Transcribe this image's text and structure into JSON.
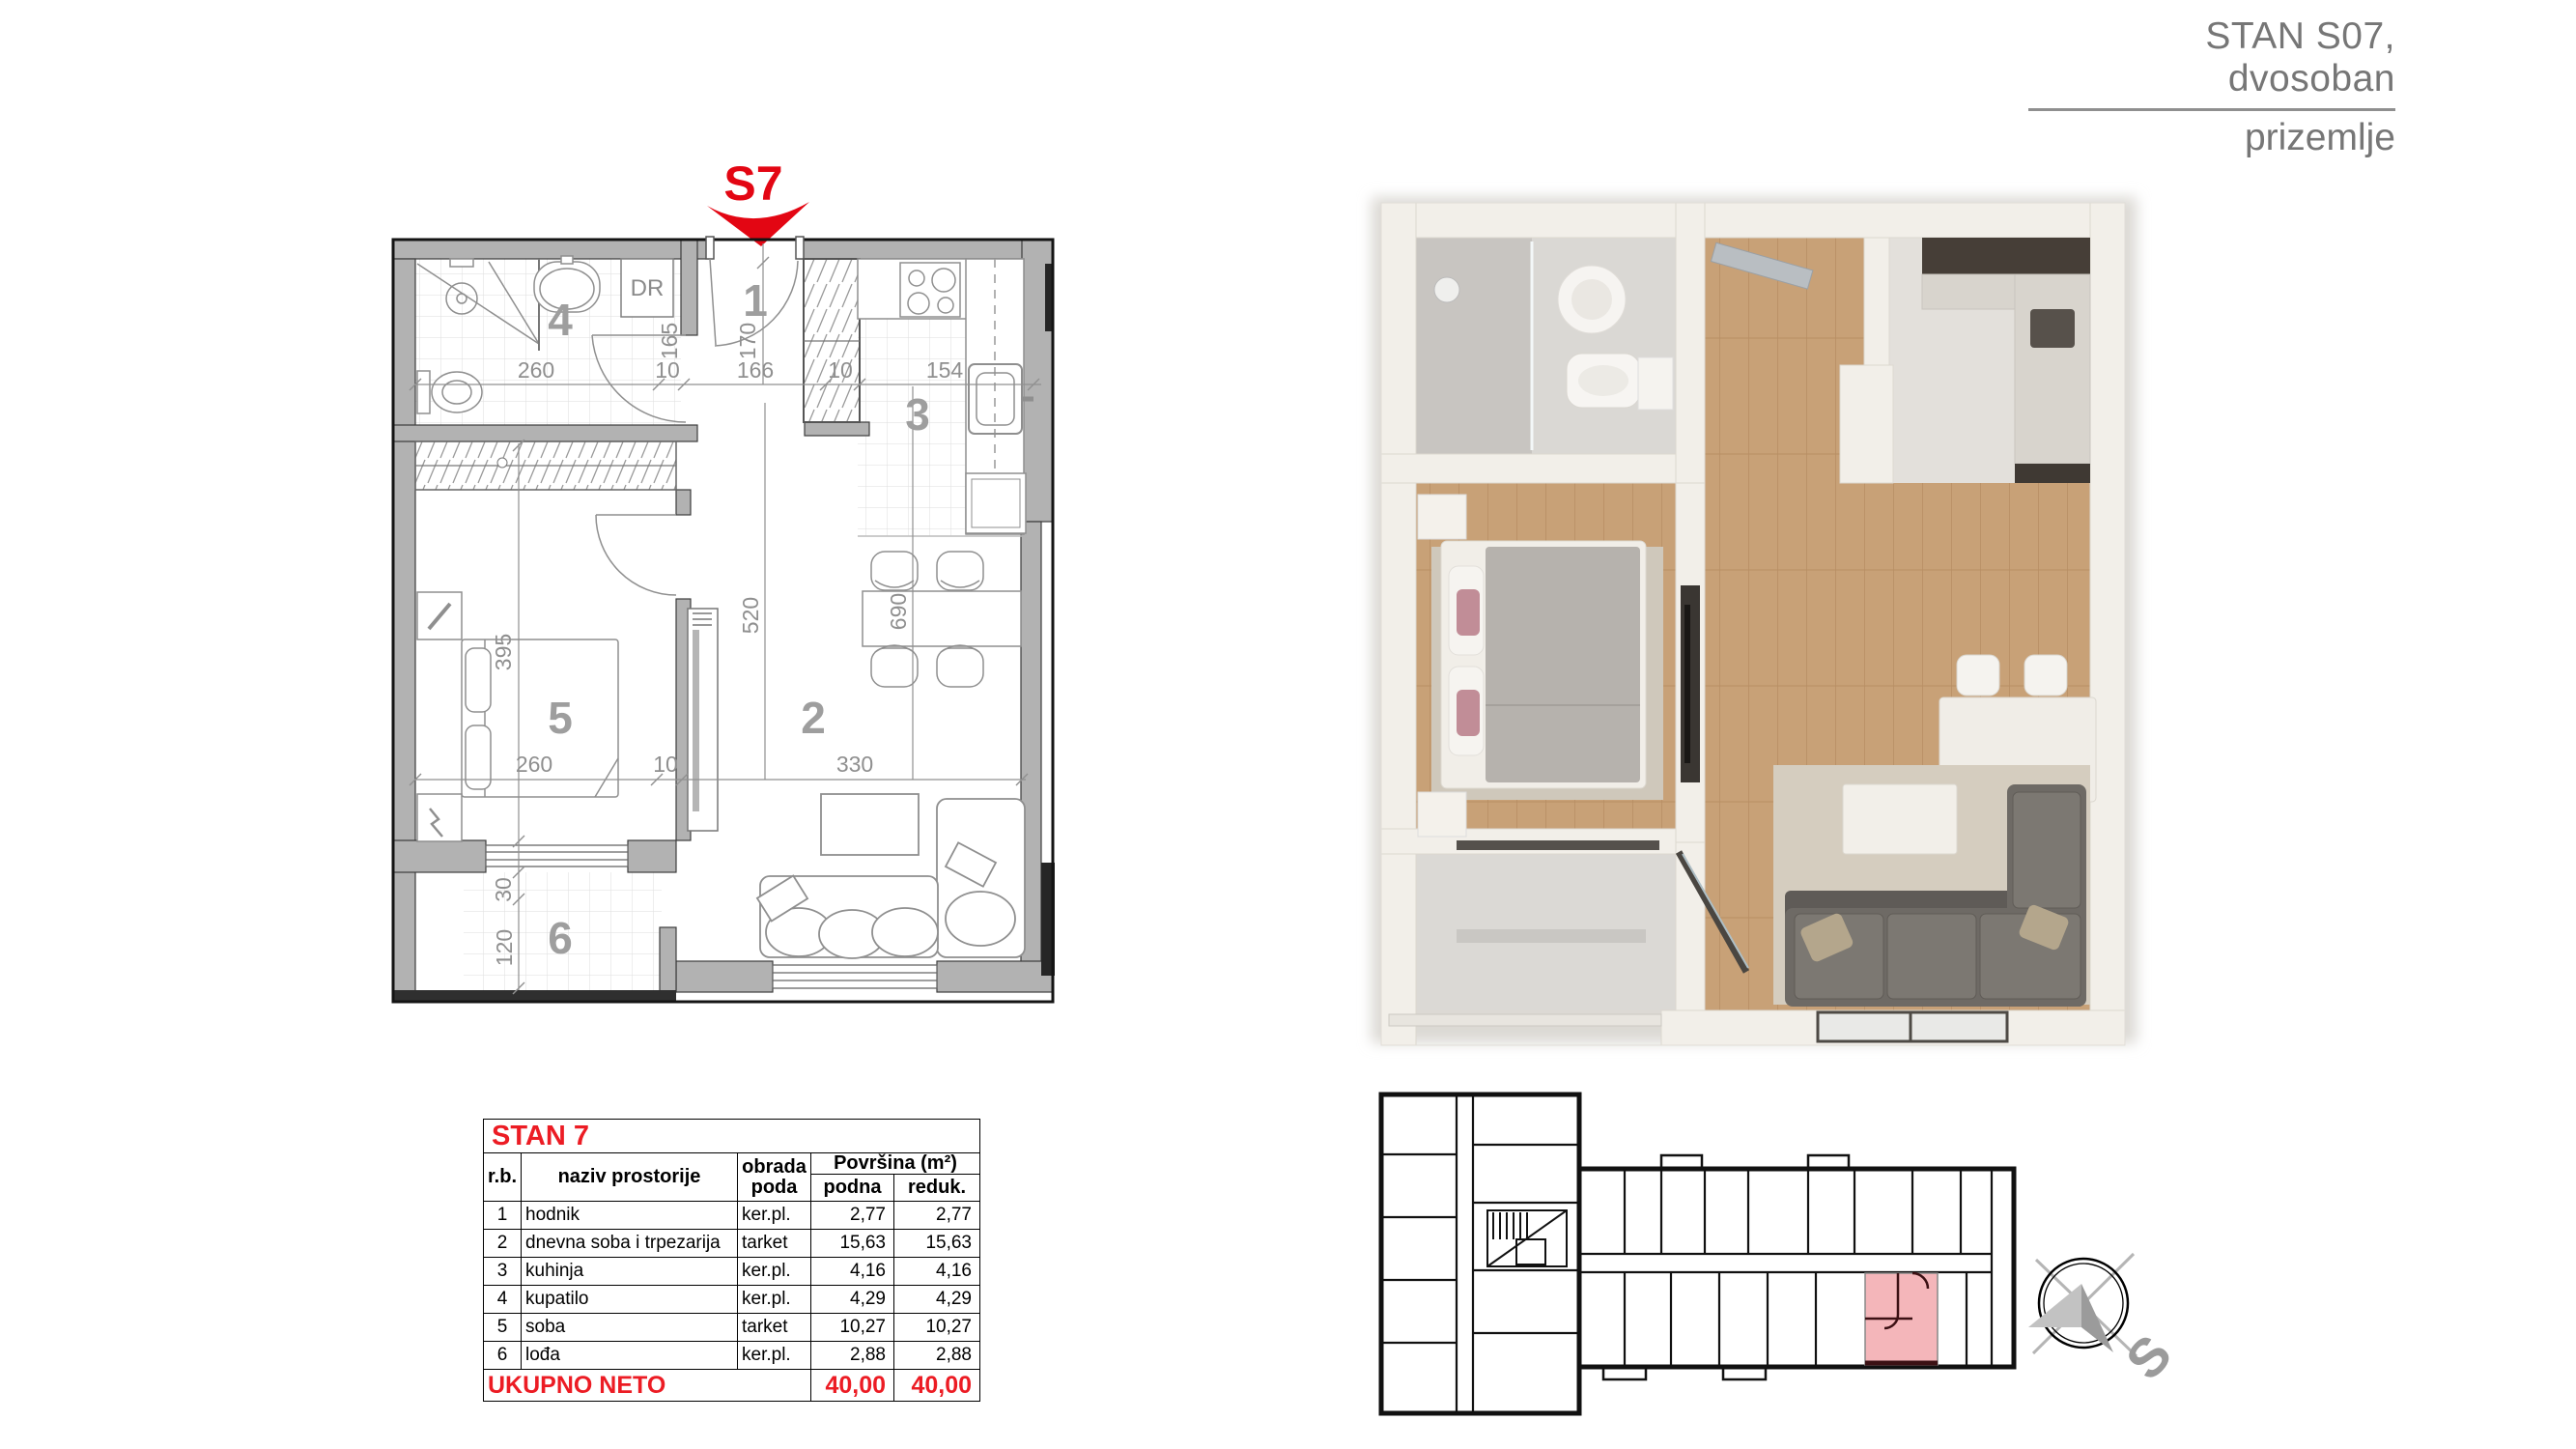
{
  "header": {
    "title": "STAN S07, dvosoban",
    "subtitle": "prizemlje"
  },
  "plan2d": {
    "unit_label": "S7",
    "labels": {
      "r1": "1",
      "r2": "2",
      "r3": "3",
      "r4": "4",
      "r5": "5",
      "r6": "6",
      "dr": "DR"
    },
    "dims": {
      "top": [
        "260",
        "10",
        "166",
        "10",
        "154"
      ],
      "mid": [
        "260",
        "10",
        "330"
      ],
      "bath_inner": "165",
      "entry": "170",
      "bedroom": "395",
      "living": "520",
      "dining": "690",
      "loggia": [
        "30",
        "120"
      ]
    }
  },
  "table": {
    "title": "STAN 7",
    "headers": {
      "rb": "r.b.",
      "name": "naziv  prostorije",
      "floor": "obrada poda",
      "area": "Površina (m²)",
      "podna": "podna",
      "reduk": "reduk."
    },
    "rows": [
      {
        "no": "1",
        "name": "hodnik",
        "floor": "ker.pl.",
        "area": "2,77",
        "reduced": "2,77"
      },
      {
        "no": "2",
        "name": "dnevna soba i trpezarija",
        "floor": "tarket",
        "area": "15,63",
        "reduced": "15,63"
      },
      {
        "no": "3",
        "name": "kuhinja",
        "floor": "ker.pl.",
        "area": "4,16",
        "reduced": "4,16"
      },
      {
        "no": "4",
        "name": "kupatilo",
        "floor": "ker.pl.",
        "area": "4,29",
        "reduced": "4,29"
      },
      {
        "no": "5",
        "name": "soba",
        "floor": "tarket",
        "area": "10,27",
        "reduced": "10,27"
      },
      {
        "no": "6",
        "name": "lođa",
        "floor": "ker.pl.",
        "area": "2,88",
        "reduced": "2,88"
      }
    ],
    "footer": {
      "label": "UKUPNO NETO",
      "area": "40,00",
      "reduced": "40,00"
    }
  },
  "compass": {
    "letter": "S"
  },
  "colors": {
    "accent_red": "#e30613",
    "table_red": "#ec1c24",
    "wall_gray": "#b2b2b2",
    "unit_highlight": "#f4b6ba"
  }
}
